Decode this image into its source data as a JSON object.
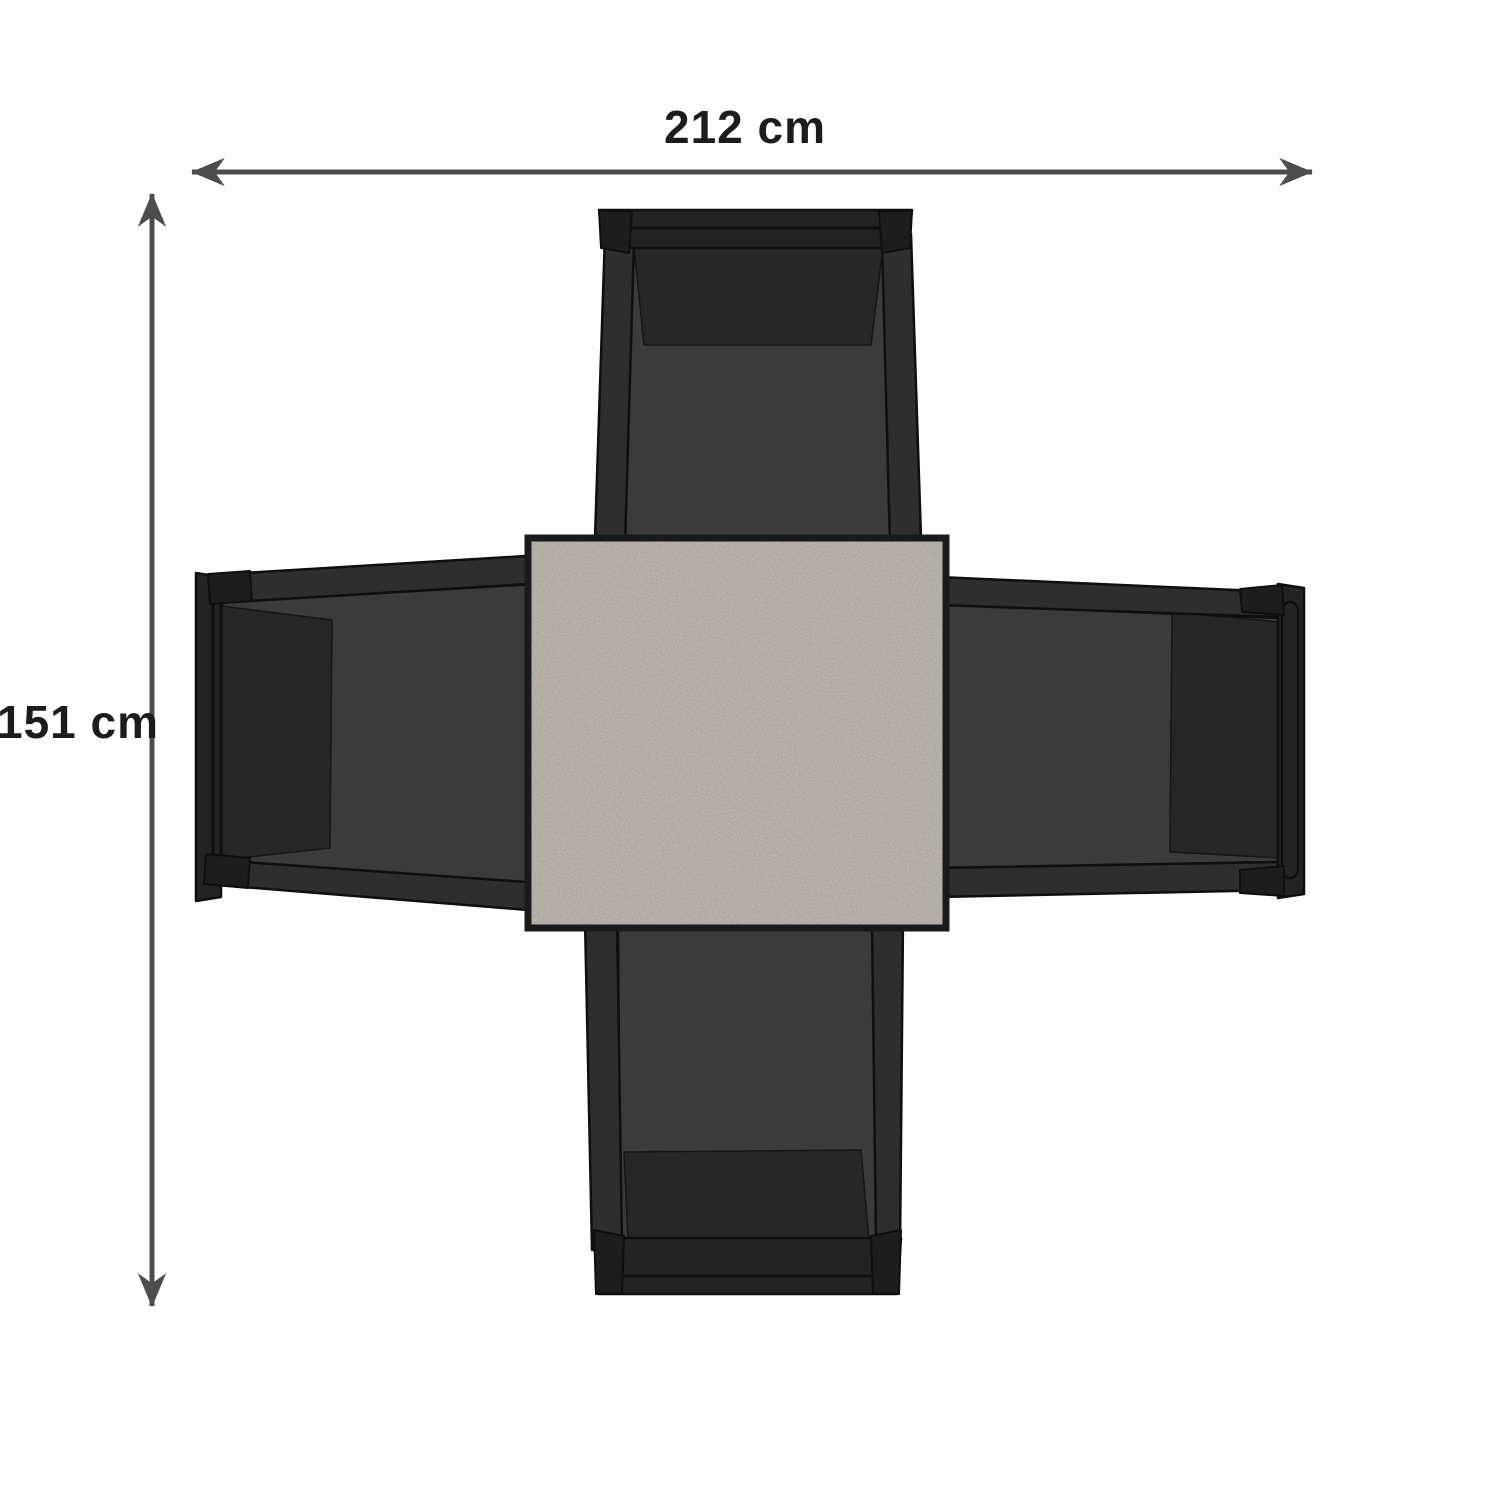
{
  "dimensions": {
    "width": {
      "label": "212 cm",
      "value": 212,
      "unit": "cm"
    },
    "height": {
      "label": "151 cm",
      "value": 151,
      "unit": "cm"
    }
  },
  "scene": {
    "description_names": [
      "square-table-top",
      "chair-top",
      "chair-right",
      "chair-bottom",
      "chair-left"
    ],
    "table": {
      "name": "square-table-top",
      "shape": "square",
      "surface": "speckled-stone-gray"
    },
    "chair_count": 4,
    "chairs": [
      {
        "name": "chair-top",
        "position": "top"
      },
      {
        "name": "chair-right",
        "position": "right"
      },
      {
        "name": "chair-bottom",
        "position": "bottom"
      },
      {
        "name": "chair-left",
        "position": "left"
      }
    ]
  },
  "colors": {
    "background": "#ffffff",
    "dimension_line": "#4d4d4d",
    "label_text": "#1c1c1c",
    "table_surface": "#a49e97",
    "table_border": "#1a1a1a",
    "chair_seat": "#3b3b3b",
    "chair_cushion": "#272727",
    "chair_frame": "#2e2e2e",
    "chair_cap": "#232323",
    "chair_outline": "#0f0f0f"
  }
}
